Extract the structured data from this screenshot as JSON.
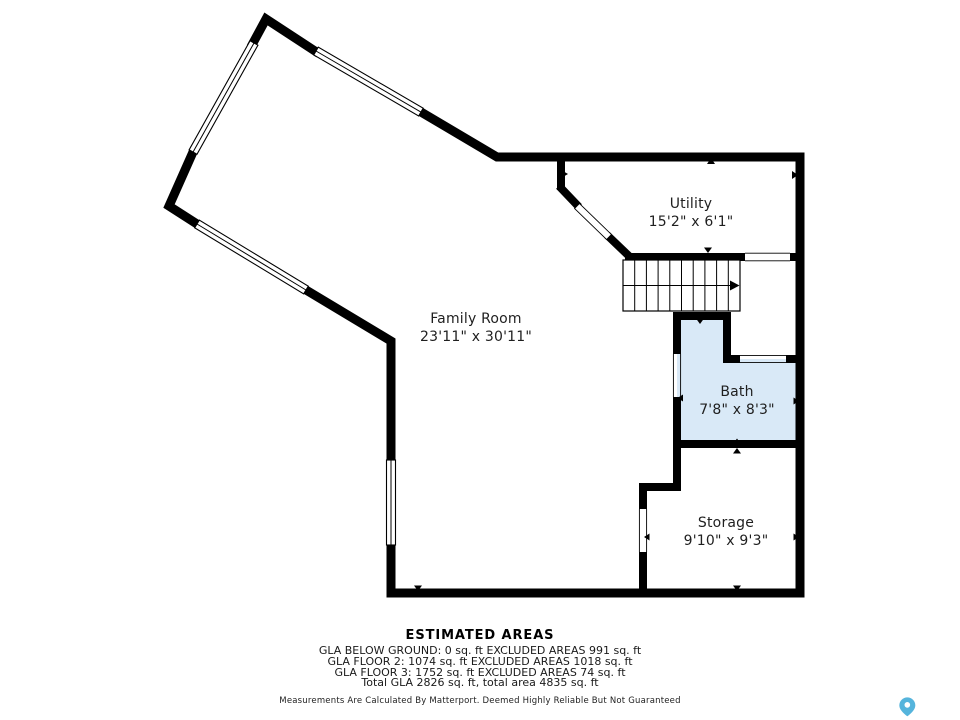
{
  "floor_plan": {
    "rooms": [
      {
        "id": "family-room",
        "name": "Family Room",
        "dimensions": "23'11\" x 30'11\""
      },
      {
        "id": "utility",
        "name": "Utility",
        "dimensions": "15'2\" x 6'1\""
      },
      {
        "id": "bath",
        "name": "Bath",
        "dimensions": "7'8\" x 8'3\""
      },
      {
        "id": "storage",
        "name": "Storage",
        "dimensions": "9'10\" x 9'3\""
      }
    ],
    "colors": {
      "wall": "#000000",
      "bath_fill": "#d9e9f7",
      "logo_blue": "#55b4dc",
      "text": "#1f1f1f"
    },
    "logo_icon": "map-pin-icon"
  },
  "footer": {
    "title": "ESTIMATED AREAS",
    "lines": [
      "GLA BELOW GROUND: 0 sq. ft EXCLUDED AREAS 991 sq. ft",
      "GLA FLOOR 2: 1074 sq. ft EXCLUDED AREAS 1018 sq. ft",
      "GLA FLOOR 3: 1752 sq. ft EXCLUDED AREAS 74 sq. ft",
      "Total GLA 2826 sq. ft, total area 4835 sq. ft"
    ],
    "disclaimer": "Measurements Are Calculated By Matterport. Deemed Highly Reliable But Not Guaranteed"
  }
}
